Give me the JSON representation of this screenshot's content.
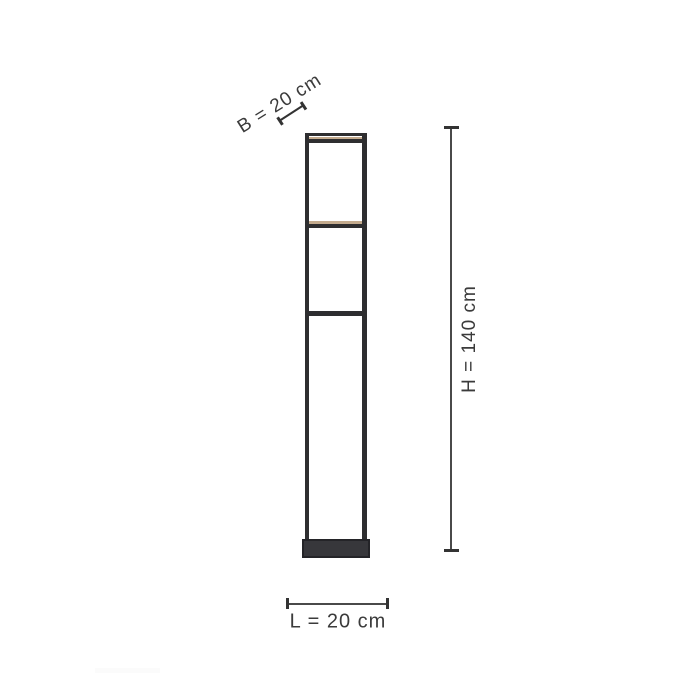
{
  "figure": {
    "labels": {
      "width": "B = 20 cm",
      "height": "H = 140 cm",
      "length": "L = 20 cm"
    },
    "colors": {
      "background": "#ffffff",
      "lamp_frame": "#2e2e30",
      "lamp_base": "#37373b",
      "led_strip": "#c4ab8e",
      "dimension_line": "#3f3f3f",
      "label_text": "#3b3b3b"
    }
  }
}
